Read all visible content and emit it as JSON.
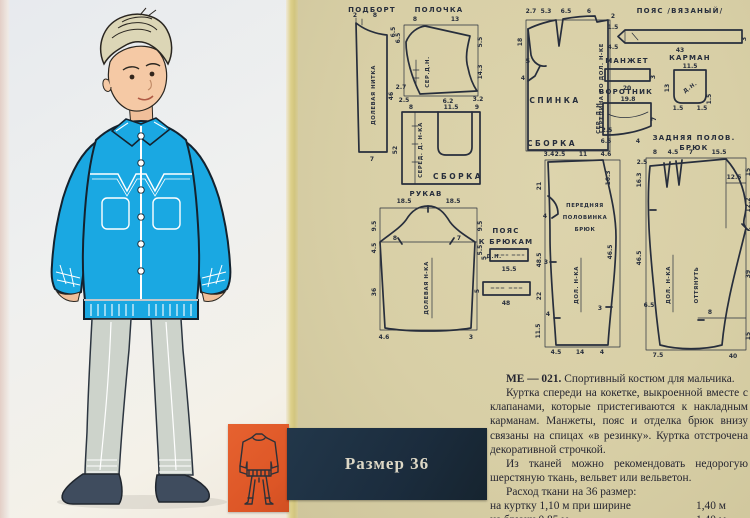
{
  "page": {
    "size_label": "Размер 36",
    "description": {
      "code": "МЕ — 021.",
      "title": "Спортивный костюм для мальчика.",
      "para1": "Куртка спереди на кокетке, выкроенной вместе с клапанами, которые пристегиваются к накладным карманам. Манжеты, пояс и отделка брюк внизу связаны на спицах «в резинку». Куртка отстрочена декоративной строчкой.",
      "para2": "Из тканей можно рекомендовать недорогую шерстяную ткань, вельвет или вельветон.",
      "fabric_heading": "Расход ткани на 36 размер:",
      "fabric_rows": [
        {
          "item": "на куртку 1,10 м при ширине",
          "ditto": "",
          "value": "1,40 м"
        },
        {
          "item": "на брюки 0,85 м",
          "ditto": "»",
          "value": "1,40 м"
        }
      ],
      "designer_label": "Конструктор Ю.",
      "designer_name": "Селиванкина"
    }
  },
  "pattern": {
    "podbort": {
      "title": "ПОДБОРТ",
      "grain": "ДОЛЕВАЯ НИТКА",
      "dims": [
        "2",
        "8",
        "6.5",
        "46",
        "7"
      ]
    },
    "polochka": {
      "title": "ПОЛОЧКА",
      "grain": "СЕР.Д.Н.",
      "dims": [
        "8",
        "13",
        "6.5",
        "5.5",
        "14.3",
        "2.7",
        "2.5",
        "6.2",
        "3.2"
      ]
    },
    "front_lower": {
      "grain": "СЕРЕД. Д. Н-КА",
      "note": "СБОРКА",
      "dims": [
        "8",
        "11.5",
        "9",
        "52"
      ]
    },
    "spinka": {
      "title": "СПИНКА",
      "grain": "СЕРЕДИНА ПО ДОЛ. Н-КЕ",
      "note": "СБОРКА",
      "dims": [
        "2.7",
        "5.3",
        "6.5",
        "6",
        "2",
        "18",
        "5",
        "4"
      ]
    },
    "poyas": {
      "title": "ПОЯС  /ВЯЗАНЫЙ/",
      "dims": [
        "1.5",
        "4.5",
        "43",
        "3"
      ]
    },
    "manzhet": {
      "title": "МАНЖЕТ",
      "dims": [
        "20",
        "3"
      ]
    },
    "karman": {
      "title": "КАРМАН",
      "grain": "Д.Н.",
      "dims": [
        "11.5",
        "13",
        "1.5",
        "1.5",
        "1.5"
      ]
    },
    "vorotnik": {
      "title": "ВОРОТНИК",
      "grain": "СЕР. Д.Н.",
      "dims": [
        "19.8",
        "2.5",
        "6.5",
        "4",
        "7"
      ]
    },
    "rukav": {
      "title": "РУКАВ",
      "grain": "ДОЛЕВАЯ Н-КА",
      "dims": [
        "18.5",
        "18.5",
        "9.5",
        "4.5",
        "8",
        "7",
        "9.5",
        "5.5",
        "36",
        "4.6",
        "3"
      ]
    },
    "poyas_bryuk": {
      "title_1": "ПОЯС",
      "title_2": "К БРЮКАМ",
      "grain": "Д.Н.",
      "dims": [
        "5",
        "15.5",
        "5",
        "48"
      ]
    },
    "perednyaya": {
      "label_1": "ПЕРЕДНЯЯ",
      "label_2": "ПОЛОВИНКА",
      "label_3": "БРЮК",
      "grain": "ДОЛ. Н-КА",
      "dims": [
        "3.4",
        "2.5",
        "11",
        "4.6",
        "21",
        "4",
        "3",
        "48.5",
        "22",
        "4",
        "11.5",
        "16.3",
        "46.5",
        "3",
        "4.5",
        "14",
        "4"
      ]
    },
    "zadnyaya": {
      "title_1": "ЗАДНЯЯ ПОЛОВ.",
      "title_2": "БРЮК",
      "grain": "ДОЛ. Н-КА",
      "stretch": "ОТТЯНУТЬ",
      "dims": [
        "8",
        "4.5",
        "7",
        "15.5",
        "2.5",
        "16.3",
        "46.5",
        "6.5",
        "7.5",
        "15",
        "12.5",
        "12.2",
        "4",
        "39",
        "8",
        "15",
        "40"
      ]
    }
  },
  "colors": {
    "jacket_blue": "#1aa8e2",
    "trousers_gray": "#cdd3cb",
    "shoes_navy": "#3f4c5e",
    "page_right_tan": "#d8cfa6",
    "gutter_yellow": "#d8cb7e",
    "size_bar_navy": "#1b2c3d",
    "swatch_orange": "#e0582a",
    "pattern_ink": "#272e3c"
  }
}
